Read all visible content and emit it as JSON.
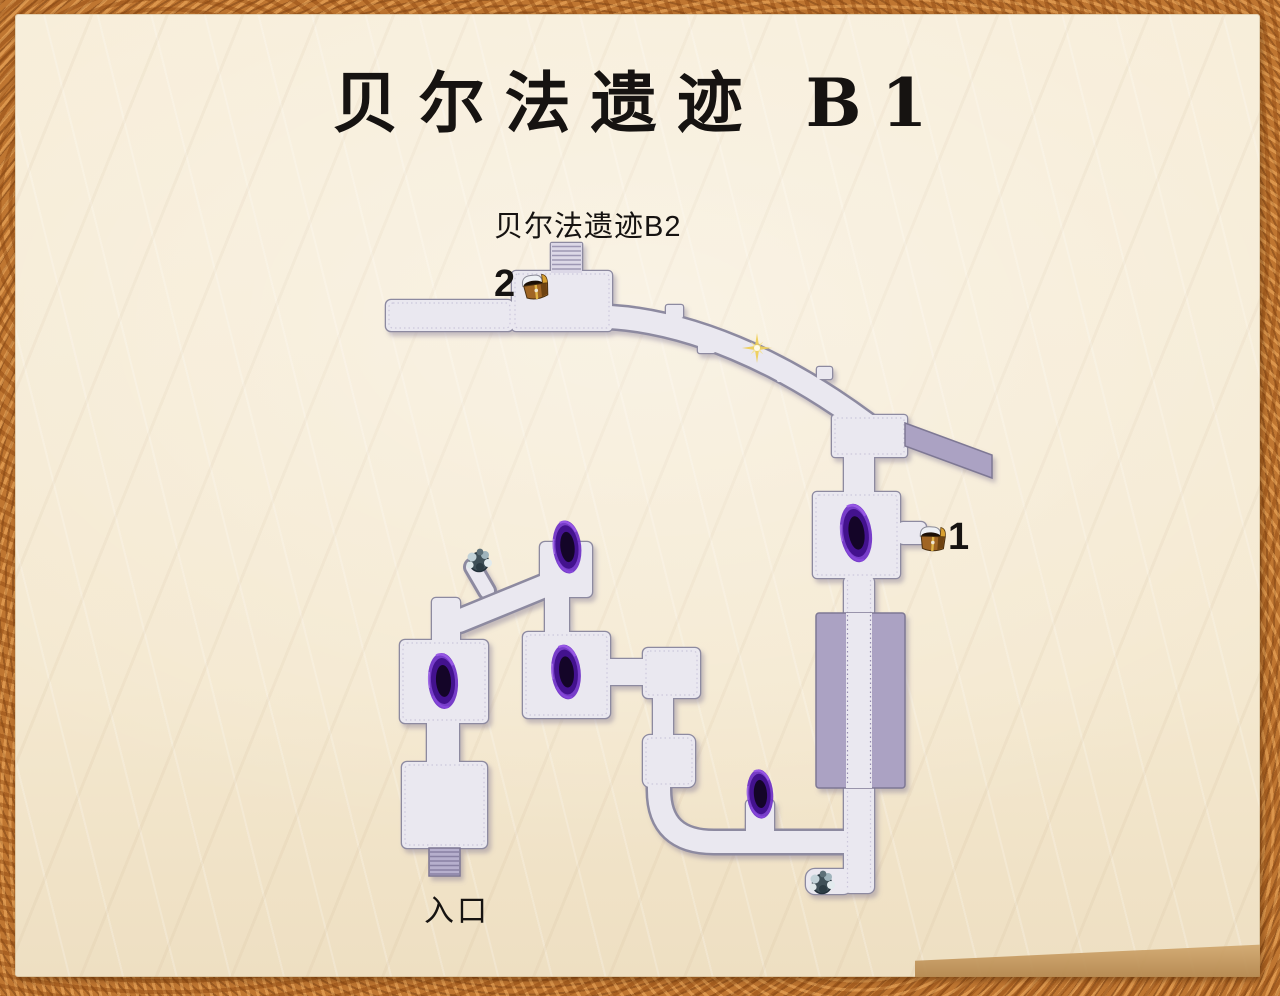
{
  "title": "贝尔法遗迹 B1",
  "labels": {
    "exit_to_b2": "贝尔法遗迹B2",
    "entrance": "入口"
  },
  "chests": [
    {
      "id": "chest-1",
      "number": "1"
    },
    {
      "id": "chest-2",
      "number": "2"
    }
  ],
  "map_features": {
    "portal_count": 5,
    "chest_count": 2,
    "rock_count": 2,
    "sparkle_count": 1,
    "stairs": [
      "stairs-to-b2",
      "entrance-stairs"
    ],
    "icon_names": [
      "portal-swirl-icon",
      "treasure-chest-icon",
      "rock-icon",
      "sparkle-icon",
      "stairs-icon"
    ]
  },
  "colors": {
    "floor": "#eae8f0",
    "floor_outline": "#8d8aa0",
    "platform": "#aba2c3",
    "portal_outer": "#6c2ec6",
    "portal_core": "#140528",
    "sparkle": "#eecf5a",
    "parchment": "#f5ead4",
    "border": "#bf7631",
    "title_text": "#161311"
  }
}
